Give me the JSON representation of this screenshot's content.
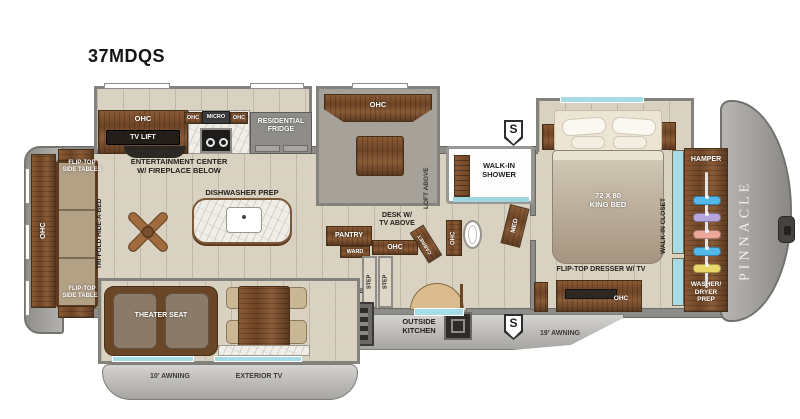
{
  "title": "37MDQS",
  "brand": "PINNACLE",
  "labels": {
    "ohc": "OHC",
    "flip_top_tables": "FLIP-TOP\nSIDE TABLES",
    "tri_fold": "TRI-FOLD HIDE-A-BED",
    "entertainment": "ENTERTAINMENT CENTER\nW/ FIREPLACE BELOW",
    "tv_lift": "TV LIFT",
    "micro": "MICRO",
    "residential_fridge": "RESIDENTIAL\nFRIDGE",
    "dishwasher_prep": "DISHWASHER PREP",
    "loft_above": "LOFT ABOVE",
    "pantry": "PANTRY",
    "ward": "WARD",
    "desk": "DESK W/\nTV ABOVE",
    "cabinet": "CABINET",
    "walk_in_shower": "WALK-IN\nSHOWER",
    "med": "MED",
    "king_bed": "72 X 80\nKING BED",
    "walk_in_closet": "WALK-IN CLOSET",
    "hamper": "HAMPER",
    "washer_dryer_prep": "WASHER/\nDRYER\nPREP",
    "flip_top_dresser": "FLIP-TOP DRESSER W/ TV",
    "step": "STEP",
    "shoe_garage": "SHOE\nGARAGE",
    "outside_kitchen": "OUTSIDE\nKITCHEN",
    "awning_19": "19' AWNING",
    "theater_seat": "THEATER SEAT",
    "awning_10": "10' AWNING",
    "exterior_tv": "EXTERIOR TV",
    "s_badge": "S"
  },
  "closet": {
    "hanger_colors": [
      "#53b7ea",
      "#b6a6dd",
      "#eba79b",
      "#53b7ea",
      "#ead76a"
    ]
  },
  "colors": {
    "floor_tile": "#d9d2c1",
    "cabinet_wood": "#6e4526",
    "body_gray": "#a7a5a2",
    "window_glass": "#a6dce6",
    "wall": "#8e8c88"
  }
}
